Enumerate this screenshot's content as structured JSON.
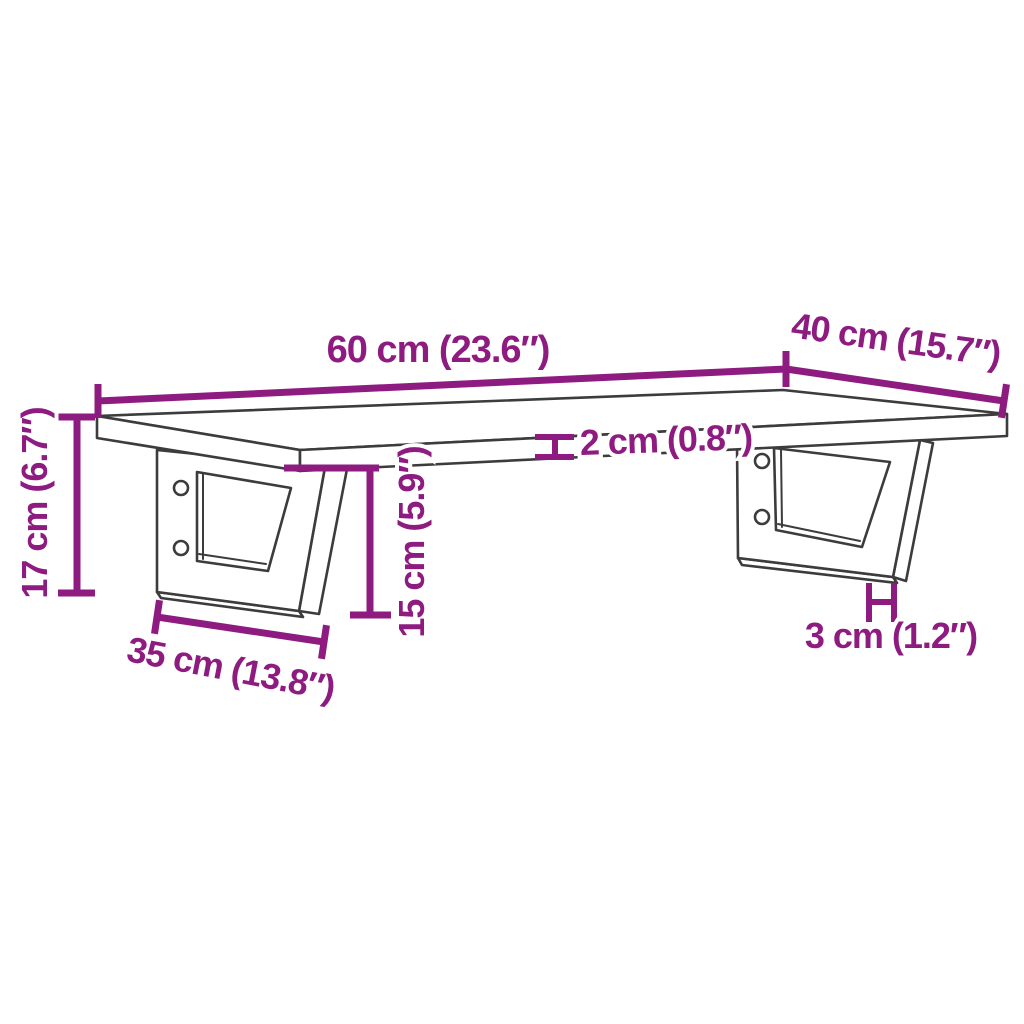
{
  "diagram": {
    "name": "wall-mounted-shelf-dimension-drawing",
    "colors": {
      "dimension_accent": "#8E1B80",
      "drawing_line": "#3C3C3C",
      "background": "#FFFFFF"
    },
    "dimensions": {
      "shelf_width": {
        "label": "60 cm (23.6″)"
      },
      "shelf_depth": {
        "label": "40 cm (15.7″)"
      },
      "total_height": {
        "label": "17 cm (6.7″)"
      },
      "shelf_thickness": {
        "label": "2 cm (0.8″)"
      },
      "bracket_height": {
        "label": "15 cm (5.9″)"
      },
      "bracket_depth": {
        "label": "35 cm (13.8″)"
      },
      "bracket_bar_width": {
        "label": "3 cm (1.2″)"
      }
    }
  }
}
